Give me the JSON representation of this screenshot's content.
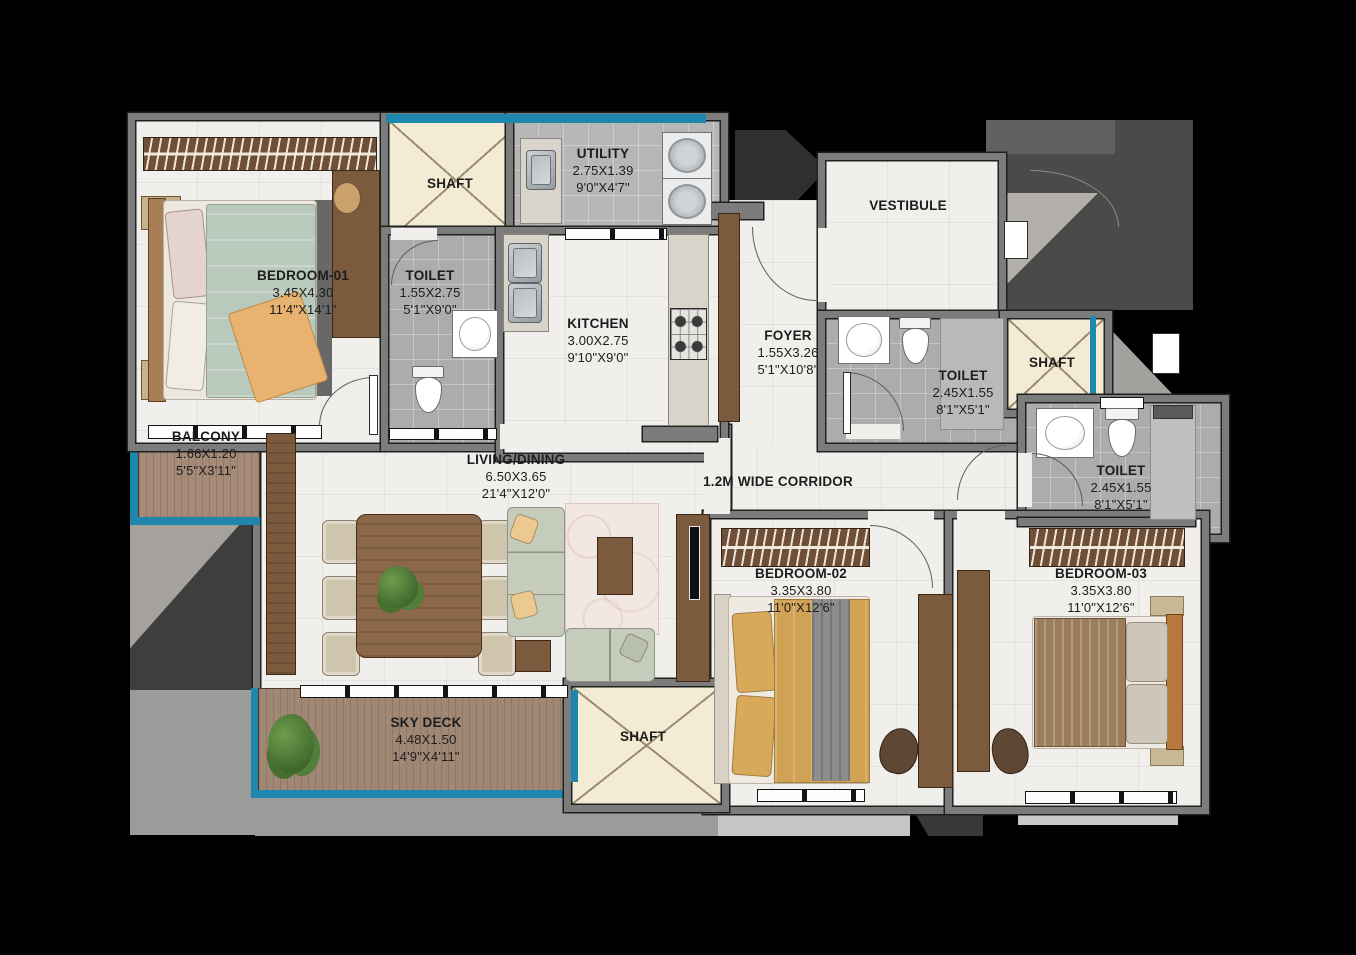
{
  "rooms": {
    "bedroom01": {
      "name": "BEDROOM-01",
      "dim_m": "3.45X4.30",
      "dim_ft": "11'4\"X14'1\""
    },
    "toilet_attached": {
      "name": "TOILET",
      "dim_m": "1.55X2.75",
      "dim_ft": "5'1\"X9'0\""
    },
    "shaft_top": {
      "name": "SHAFT"
    },
    "utility": {
      "name": "UTILITY",
      "dim_m": "2.75X1.39",
      "dim_ft": "9'0\"X4'7\""
    },
    "kitchen": {
      "name": "KITCHEN",
      "dim_m": "3.00X2.75",
      "dim_ft": "9'10\"X9'0\""
    },
    "vestibule": {
      "name": "VESTIBULE"
    },
    "foyer": {
      "name": "FOYER",
      "dim_m": "1.55X3.26",
      "dim_ft": "5'1\"X10'8\""
    },
    "toilet_common": {
      "name": "TOILET",
      "dim_m": "2.45X1.55",
      "dim_ft": "8'1\"X5'1\""
    },
    "shaft_right": {
      "name": "SHAFT"
    },
    "toilet_bed03": {
      "name": "TOILET",
      "dim_m": "2.45X1.55",
      "dim_ft": "8'1\"X5'1\""
    },
    "balcony": {
      "name": "BALCONY",
      "dim_m": "1.66X1.20",
      "dim_ft": "5'5\"X3'11\""
    },
    "living_dining": {
      "name": "LIVING/DINING",
      "dim_m": "6.50X3.65",
      "dim_ft": "21'4\"X12'0\""
    },
    "corridor": {
      "name": "1.2M WIDE CORRIDOR"
    },
    "bedroom02": {
      "name": "BEDROOM-02",
      "dim_m": "3.35X3.80",
      "dim_ft": "11'0\"X12'6\""
    },
    "bedroom03": {
      "name": "BEDROOM-03",
      "dim_m": "3.35X3.80",
      "dim_ft": "11'0\"X12'6\""
    },
    "sky_deck": {
      "name": "SKY DECK",
      "dim_m": "4.48X1.50",
      "dim_ft": "14'9\"X4'11\""
    },
    "shaft_bottom": {
      "name": "SHAFT"
    }
  },
  "theme": {
    "accent_teal": "#1d87ad",
    "wall_gray": "#7c7c7c",
    "floor_marble": "#f1efec",
    "tile_gray": "#acacac",
    "shaft_cream": "#f4ebd5",
    "wood_brown": "#7c5a3e",
    "deck_wood": "#a08875",
    "background": "#000000"
  }
}
